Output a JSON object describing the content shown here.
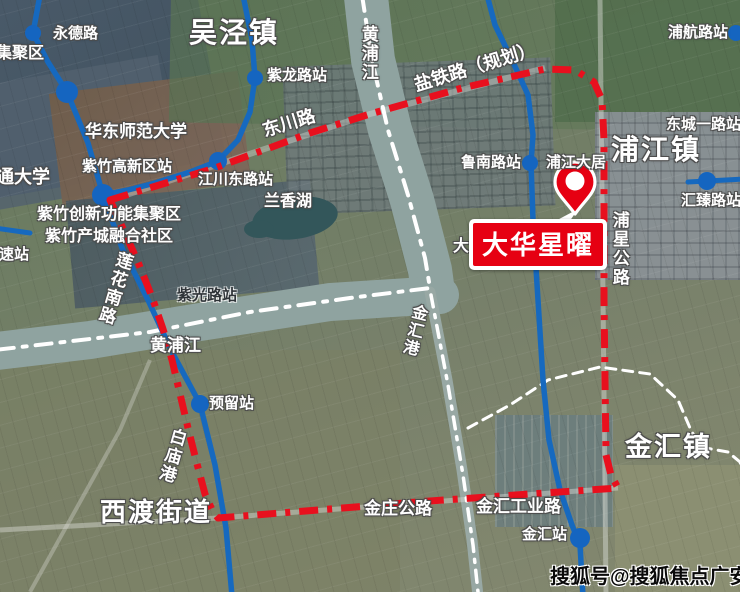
{
  "project": {
    "callout_label": "大华星曜"
  },
  "watermark": {
    "text": "搜狐号@搜狐焦点广安站"
  },
  "towns": {
    "wujing": "吴泾镇",
    "pujiang": "浦江镇",
    "jinhui": "金汇镇",
    "xidu": "西渡街道"
  },
  "stations": {
    "yongde": "永德路",
    "zilong": "紫龙路站",
    "jiangchuandong": "江川东路站",
    "zizhu_hitech": "紫竹高新区站",
    "ziguang": "紫光路站",
    "lunan": "鲁南路站",
    "puhang": "浦航路站",
    "dongcheng": "东城一路站",
    "huizhen": "汇臻路站",
    "yuliu": "预留站",
    "jinhui_station": "金汇站",
    "gaosu": "高速站"
  },
  "roads": {
    "dongchuan": "东川路",
    "yantie": "盐铁路（规划）",
    "lianhua": "莲花南路",
    "puxing": "浦星公路",
    "jinzhuang": "金庄公路",
    "jinhui_industrial": "金汇工业路"
  },
  "waters": {
    "huangpu_vertical": "黄浦江",
    "huangpu_horizontal": "黄浦江",
    "lanxiang_lake": "兰香湖",
    "baimiao": "白庙港",
    "jinhuigang": "金汇港",
    "dazhihe_partial": "大"
  },
  "areas": {
    "jijuqu_partial": "集聚区",
    "jiaotong_univ": "交通大学",
    "ecnu": "华东师范大学",
    "zizhu_innovation": "紫竹创新功能集聚区",
    "zizhu_city": "紫竹产城融合社区",
    "pujiang_daju": "浦江大居"
  },
  "colors": {
    "boundary_red": "#e8101e",
    "callout_red": "#e60012",
    "metro_blue": "#1669bf",
    "label_white": "#ffffff",
    "watermark_black": "#0a0a0a"
  }
}
